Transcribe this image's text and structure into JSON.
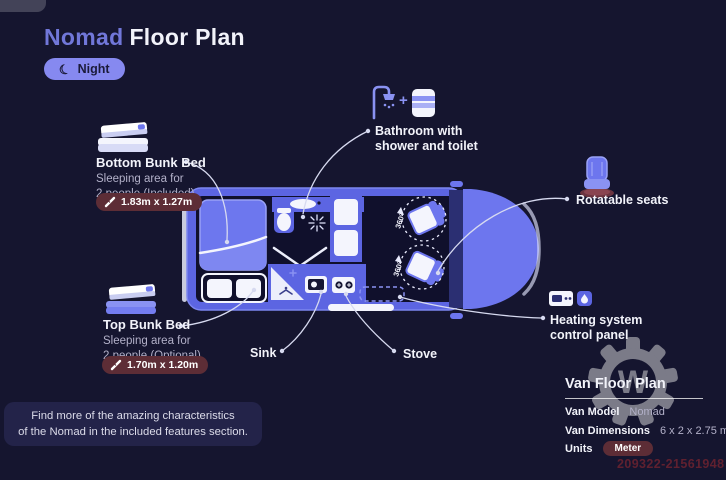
{
  "colors": {
    "background": "#15152f",
    "accent_purple": "#7177d9",
    "van_blue": "#5c65e2",
    "pill_purple": "#8689f0",
    "badge_maroon": "#5d2d36",
    "text_white": "#f2f3fa",
    "text_muted": "#b3b1c9"
  },
  "header": {
    "title_accent": "Nomad",
    "title_rest": "Floor Plan",
    "mode_label": "Night",
    "mode_icon": "moon-icon"
  },
  "callouts": {
    "bottom_bunk": {
      "title": "Bottom Bunk Bed",
      "desc1": "Sleeping area for",
      "desc2": "2 people (Included)",
      "dimensions": "1.83m x 1.27m"
    },
    "top_bunk": {
      "title": "Top Bunk Bed",
      "desc1": "Sleeping area for",
      "desc2": "2 people (Optional)",
      "dimensions": "1.70m x 1.20m"
    },
    "bathroom": {
      "line1": "Bathroom with",
      "line2": "shower and toilet",
      "plus": "+"
    },
    "rotatable_seats": {
      "label": "Rotatable seats"
    },
    "heating": {
      "line1": "Heating system",
      "line2": "control panel"
    },
    "sink": {
      "label": "Sink"
    },
    "stove": {
      "label": "Stove"
    }
  },
  "floor_plan": {
    "seat_rotation": "360°"
  },
  "info_panel": {
    "title": "Van Floor Plan",
    "model_label": "Van Model",
    "model_value": "Nomad",
    "dimensions_label": "Van Dimensions",
    "dimensions_value": "6 x 2 x 2.75 m",
    "units_label": "Units",
    "units_value": "Meter"
  },
  "footer_note": {
    "line1": "Find more of the amazing characteristics",
    "line2": "of the Nomad in the included features section."
  },
  "watermark": {
    "id": "209322-21561948",
    "logo_letter": "W"
  }
}
